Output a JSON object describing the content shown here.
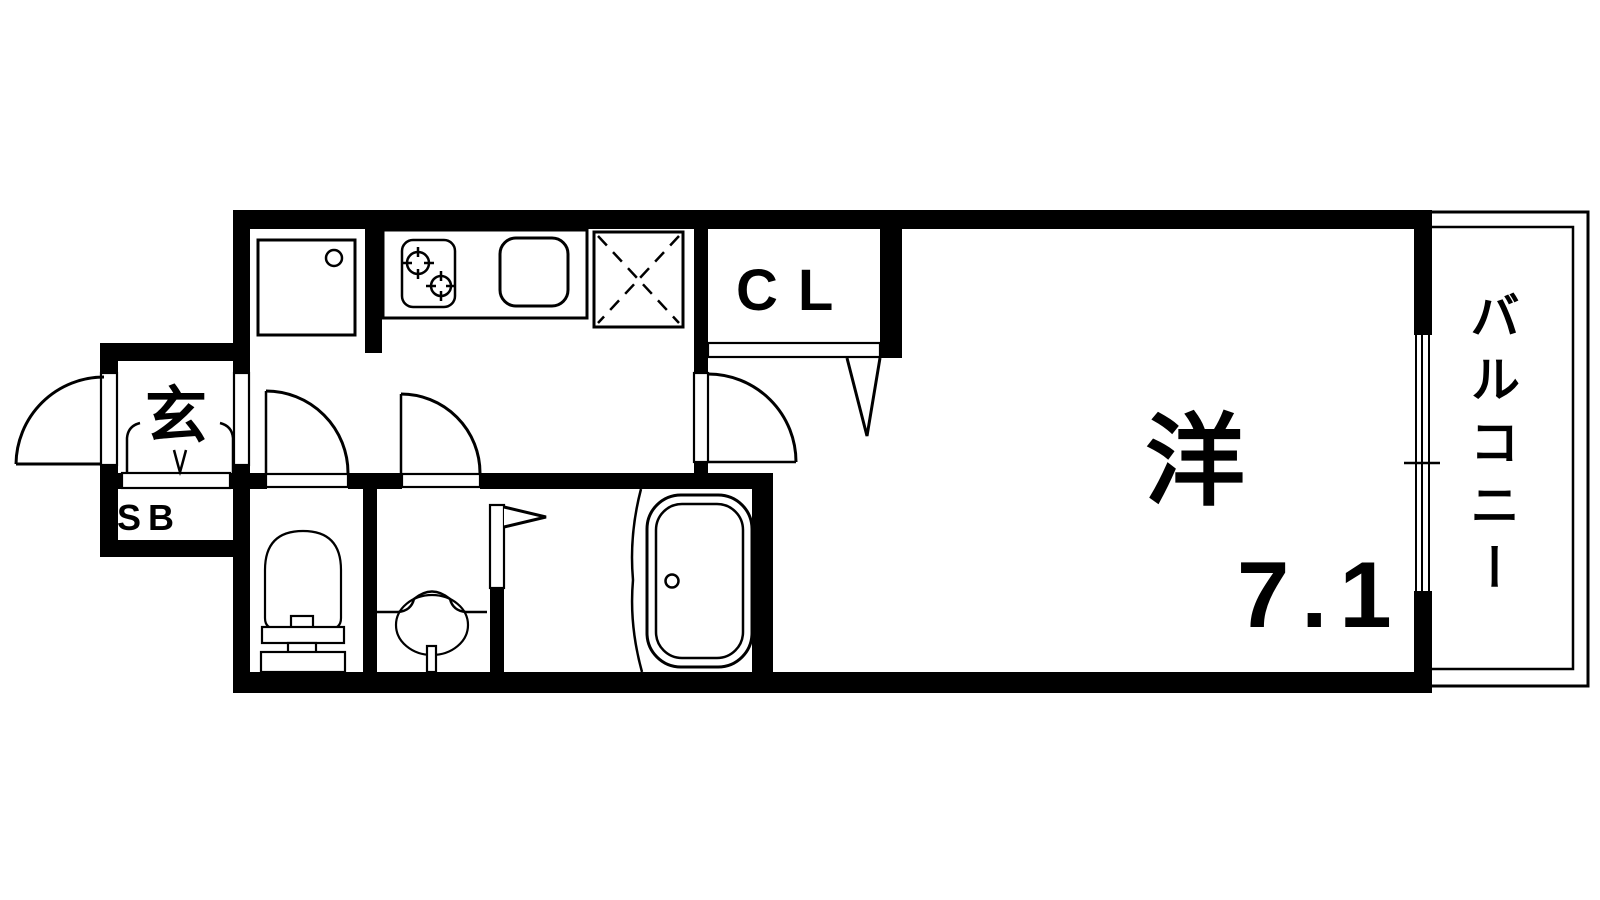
{
  "plan": {
    "type": "apartment-floor-plan",
    "colors": {
      "background": "#ffffff",
      "wall": "#000000",
      "line": "#000000"
    },
    "labels": {
      "entrance": "玄",
      "shoe_box": "SB",
      "closet": "CL",
      "room": "洋",
      "room_size": "7.1",
      "balcony": "バルコニー"
    },
    "fixtures": [
      "washing-machine-space",
      "gas-stove-two-burners",
      "kitchen-sink",
      "refrigerator-space",
      "toilet",
      "washbasin",
      "bathtub",
      "sliding-window",
      "hinged-doors",
      "closet-folding-door",
      "bathroom-folding-door"
    ]
  }
}
